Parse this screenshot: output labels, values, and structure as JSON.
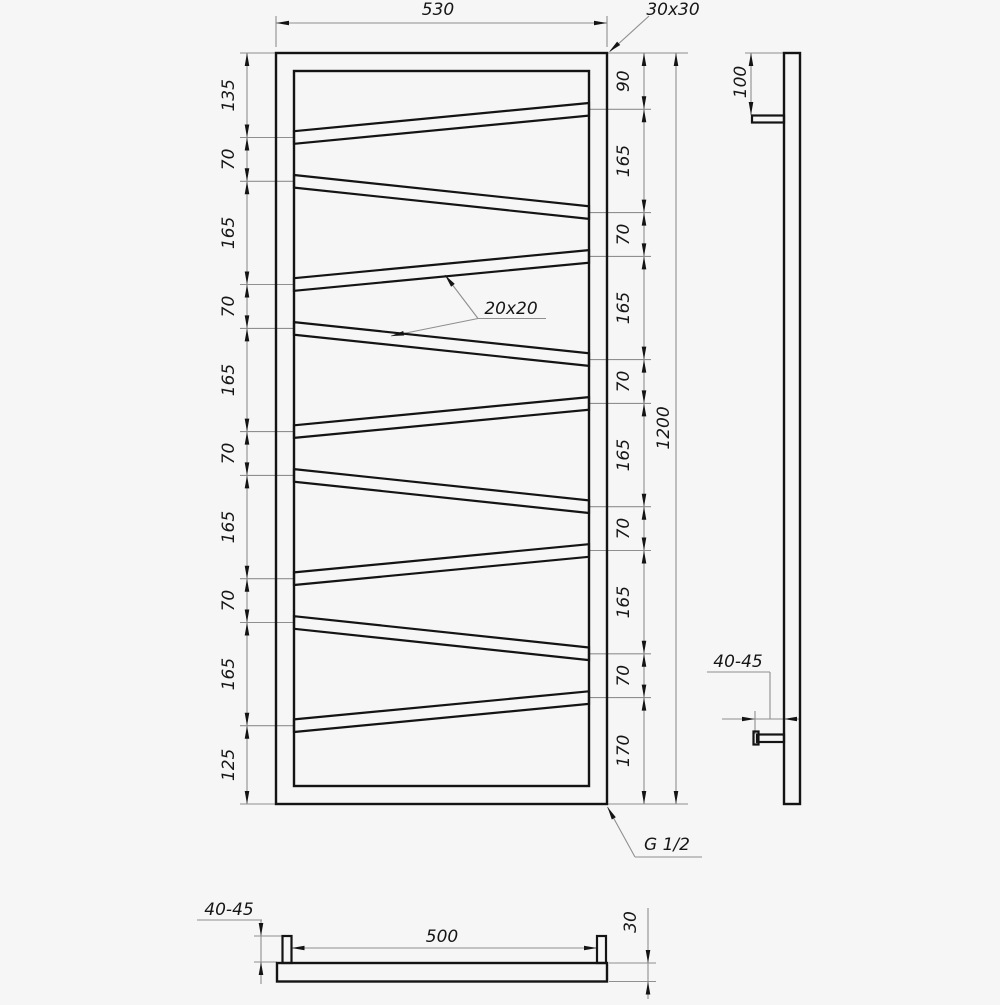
{
  "front_view": {
    "width": "530",
    "frame_profile": "30x30",
    "bar_profile": "20x20",
    "height": "1200",
    "thread": "G 1/2",
    "left_chain": [
      "135",
      "70",
      "165",
      "70",
      "165",
      "70",
      "165",
      "70",
      "165",
      "125"
    ],
    "right_chain": [
      "90",
      "165",
      "70",
      "165",
      "70",
      "165",
      "70",
      "165",
      "70",
      "170"
    ]
  },
  "side_view": {
    "top_offset": "100",
    "wall_distance": "40-45"
  },
  "bottom_view": {
    "mount_spacing": "500",
    "wall_distance": "40-45",
    "depth": "30"
  }
}
